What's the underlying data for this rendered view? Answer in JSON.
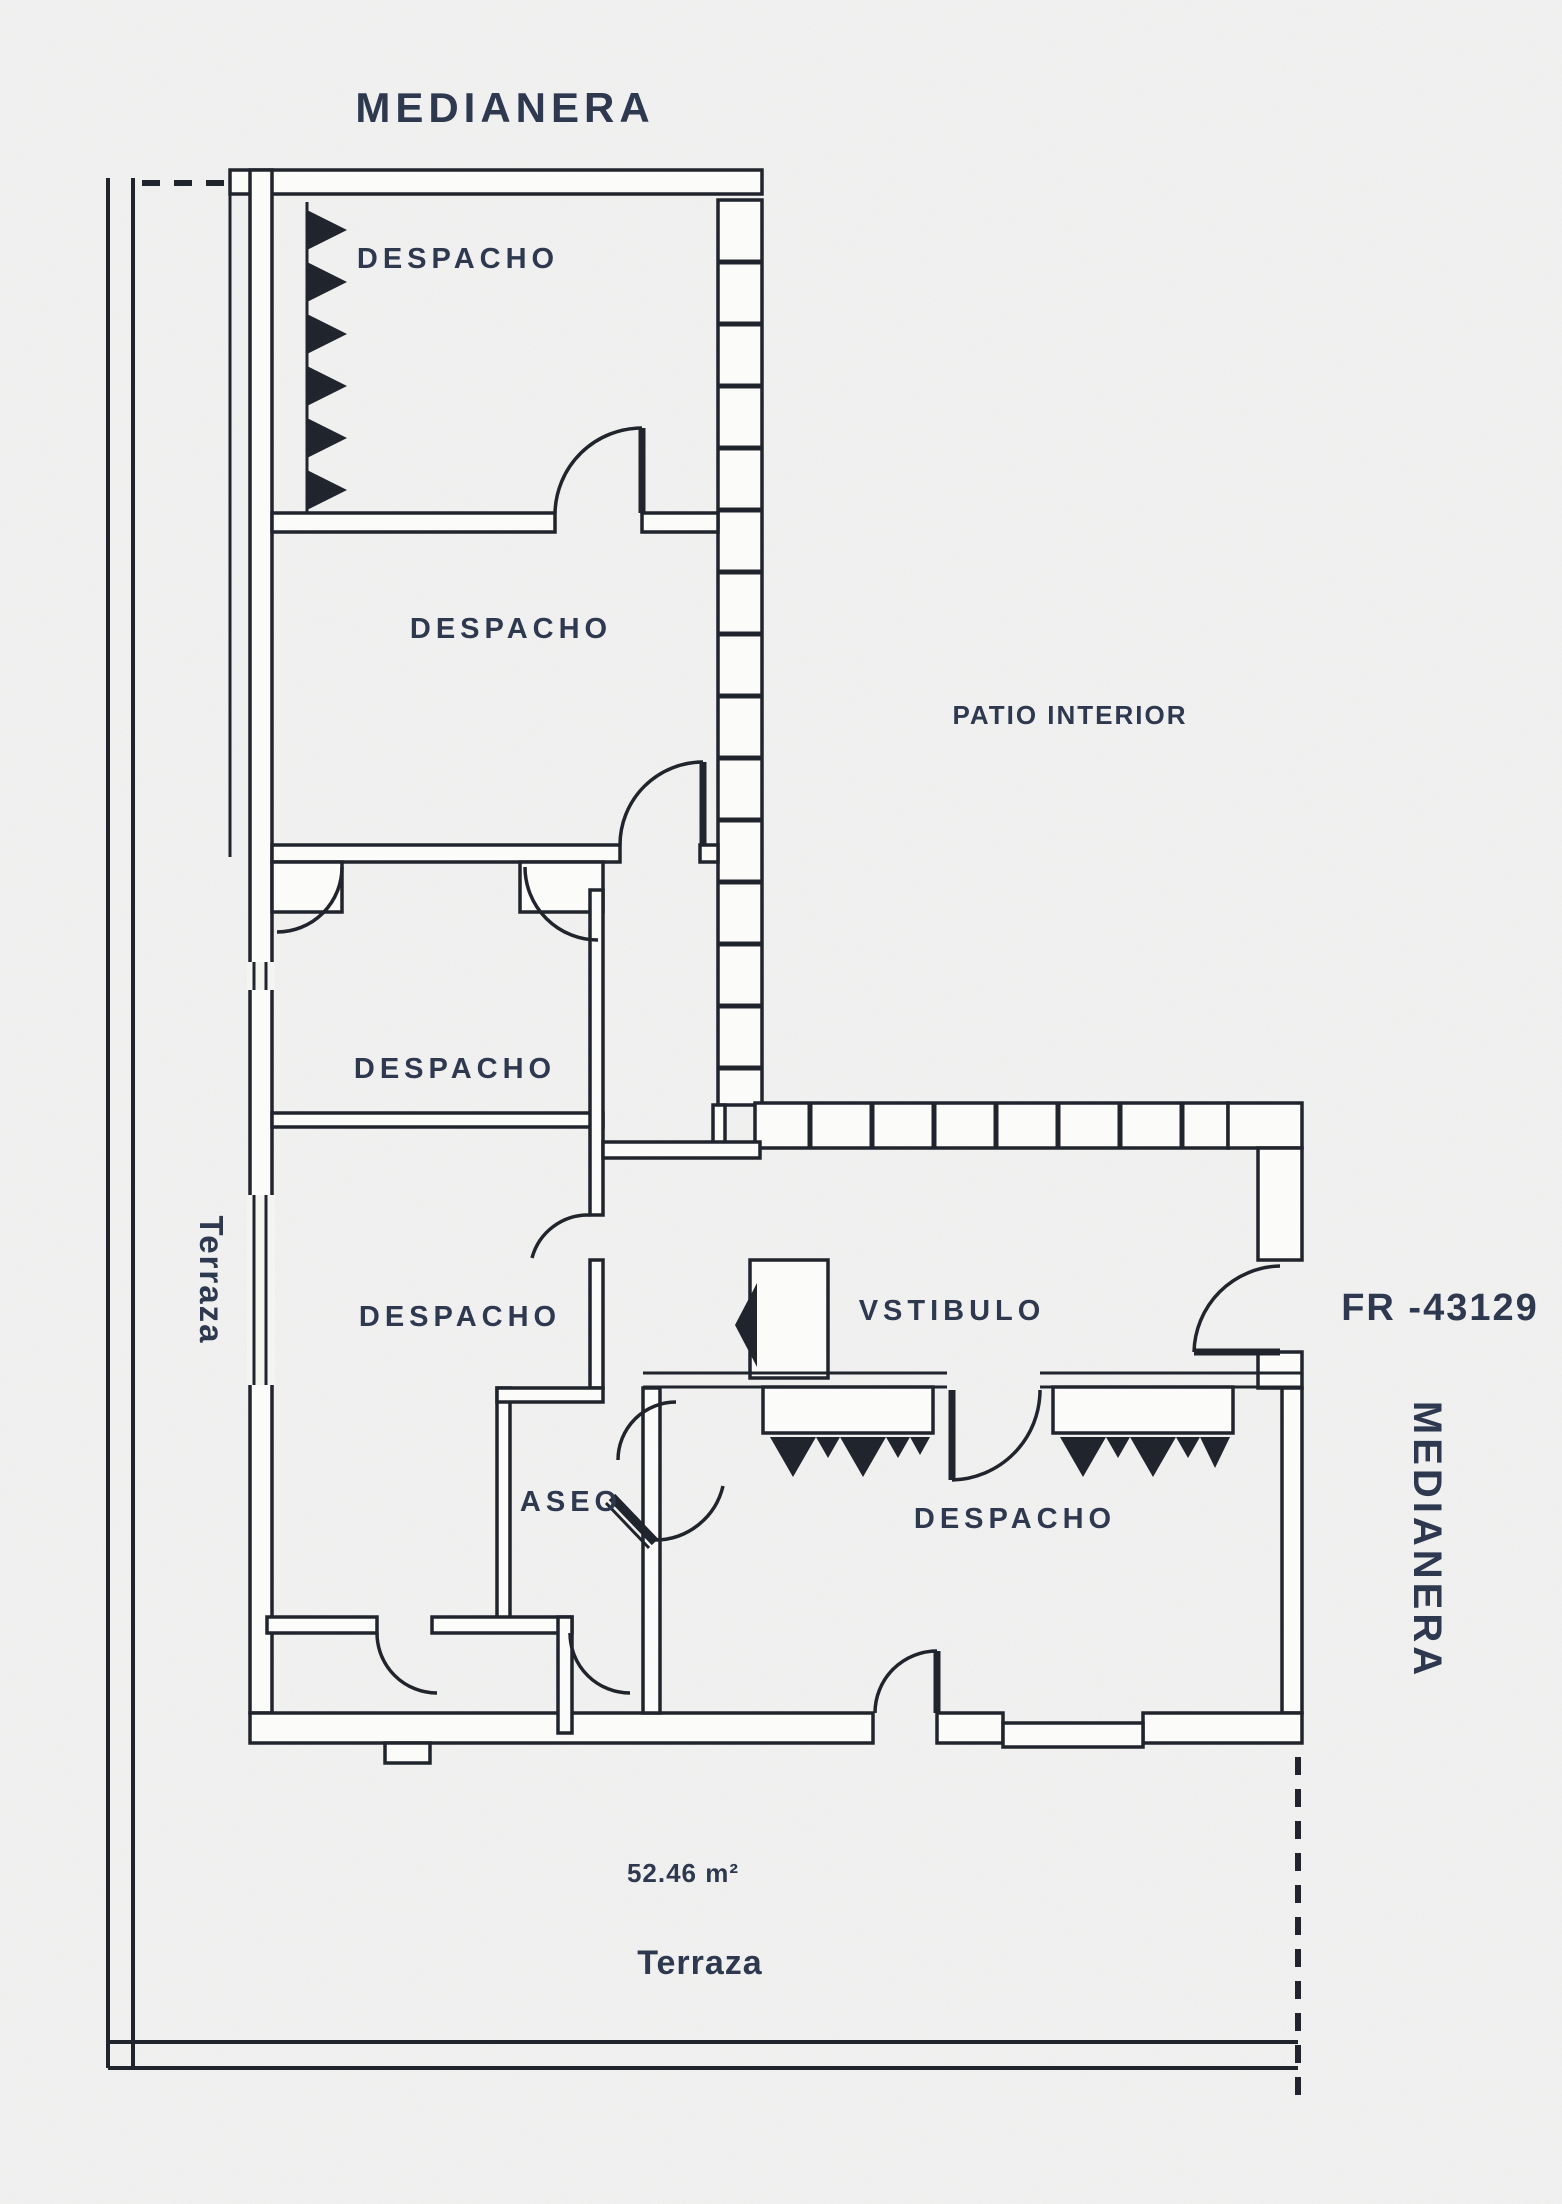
{
  "plan": {
    "reference": "FR -43129",
    "area_label": "52.46 m²",
    "boundaries": {
      "medianera_top": "MEDIANERA",
      "medianera_right": "MEDIANERA",
      "terraza_left": "Terraza",
      "terraza_bottom": "Terraza"
    },
    "rooms": [
      {
        "name": "despacho-1",
        "label": "DESPACHO"
      },
      {
        "name": "despacho-2",
        "label": "DESPACHO"
      },
      {
        "name": "despacho-3",
        "label": "DESPACHO"
      },
      {
        "name": "despacho-4",
        "label": "DESPACHO"
      },
      {
        "name": "despacho-5",
        "label": "DESPACHO"
      },
      {
        "name": "aseo",
        "label": "ASEO"
      },
      {
        "name": "vestibulo",
        "label": "VSTIBULO"
      },
      {
        "name": "patio",
        "label": "PATIO INTERIOR"
      }
    ],
    "colors": {
      "paper": "#f4f4f3",
      "ink": "#20242c",
      "label_ink": "#2e3950"
    }
  }
}
